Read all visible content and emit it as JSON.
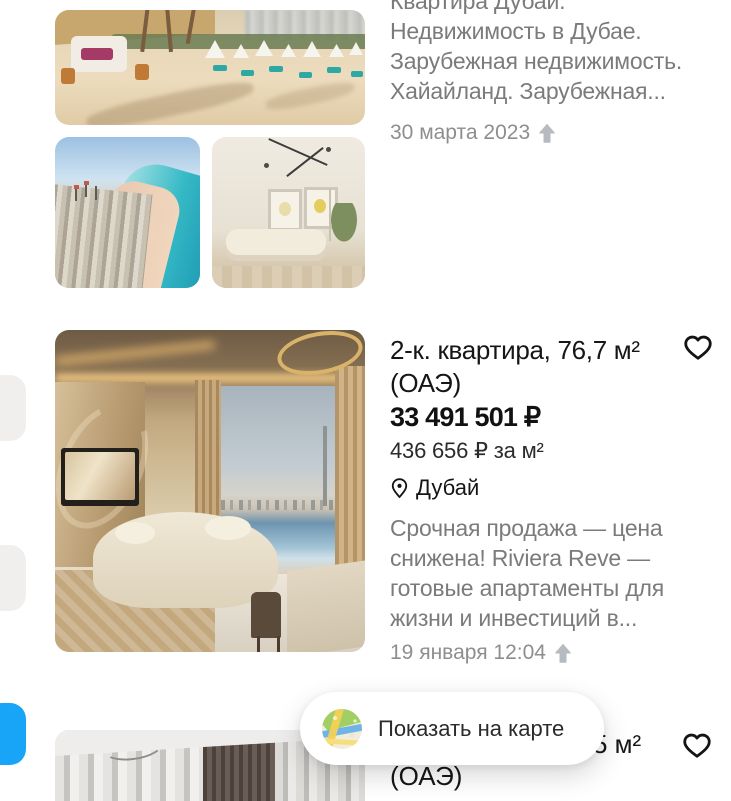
{
  "colors": {
    "accent_blue": "#19a5f7",
    "text_primary": "#161616",
    "text_secondary": "#7b7b7b",
    "text_date": "#8e8e8e",
    "arrow_gray": "#b5bbc1"
  },
  "listing1": {
    "description_lines": [
      "Квартира Дубай.",
      "Недвижимость в Дубае.",
      "Зарубежная недвижимость.",
      "Хайайланд. Зарубежная..."
    ],
    "date": "30 марта 2023",
    "photos": [
      "beach-club",
      "aerial-coastline",
      "bright-living-room"
    ]
  },
  "listing2": {
    "title_line1": "2-к. квартира, 76,7 м²",
    "title_line2": "(ОАЭ)",
    "price": "33 491 501 ₽",
    "price_per_m2": "436 656 ₽ за м²",
    "location": "Дубай",
    "description_lines": [
      "Срочная продажа — цена",
      "снижена! Riviera Reve —",
      "готовые апартаменты для",
      "жизни и инвестиций в..."
    ],
    "date": "19 января 12:04",
    "photo": "luxury-living-room-dubai-view"
  },
  "listing3": {
    "title_visible_fragment": "5 м²",
    "title_line2": "(ОАЭ)",
    "photo": "curtains-interior"
  },
  "map_button": {
    "label": "Показать на карте"
  }
}
